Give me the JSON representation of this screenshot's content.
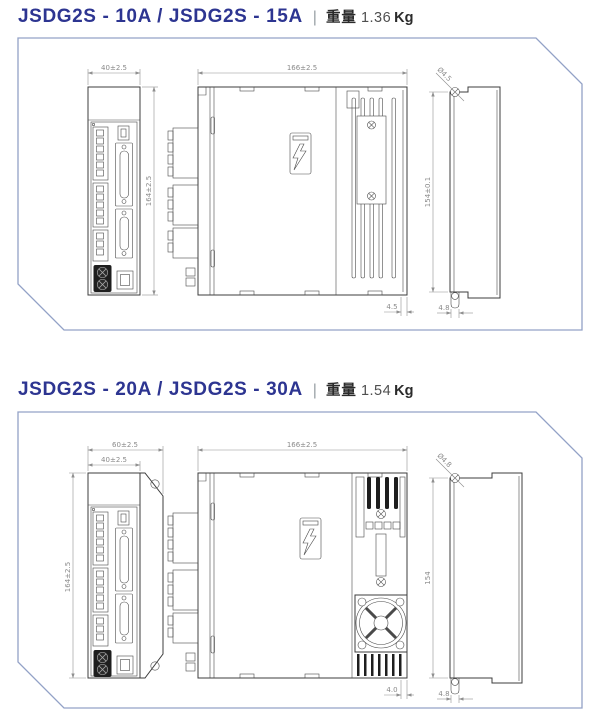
{
  "page": {
    "background": "#ffffff",
    "accent_color": "#2d3591",
    "panel_border_color": "#93a2c7",
    "drawing_line_color": "#3c3c3c",
    "dimension_color": "#8a8a8a"
  },
  "sections": [
    {
      "title": "JSDG2S - 10A / JSDG2S - 15A",
      "separator": "|",
      "weight": {
        "label": "重量",
        "value": "1.36",
        "unit": "Kg"
      },
      "dims": {
        "front_width": "40±2.5",
        "front_height": "164±2.5",
        "side_length": "166±2.5",
        "side_bottom_offset": "4.5",
        "rear_hole_dia": "Ø4.5",
        "rear_hole_pitch": "154±0.1",
        "rear_slot_width": "4.8"
      }
    },
    {
      "title": "JSDG2S - 20A / JSDG2S - 30A",
      "separator": "|",
      "weight": {
        "label": "重量",
        "value": "1.54",
        "unit": "Kg"
      },
      "dims": {
        "front_outer_width": "60±2.5",
        "front_inner_width": "40±2.5",
        "front_height": "164±2.5",
        "side_length": "166±2.5",
        "side_bottom_offset": "4.0",
        "rear_hole_dia": "Ø4.8",
        "rear_hole_pitch": "154",
        "rear_slot_width": "4.8"
      }
    }
  ]
}
